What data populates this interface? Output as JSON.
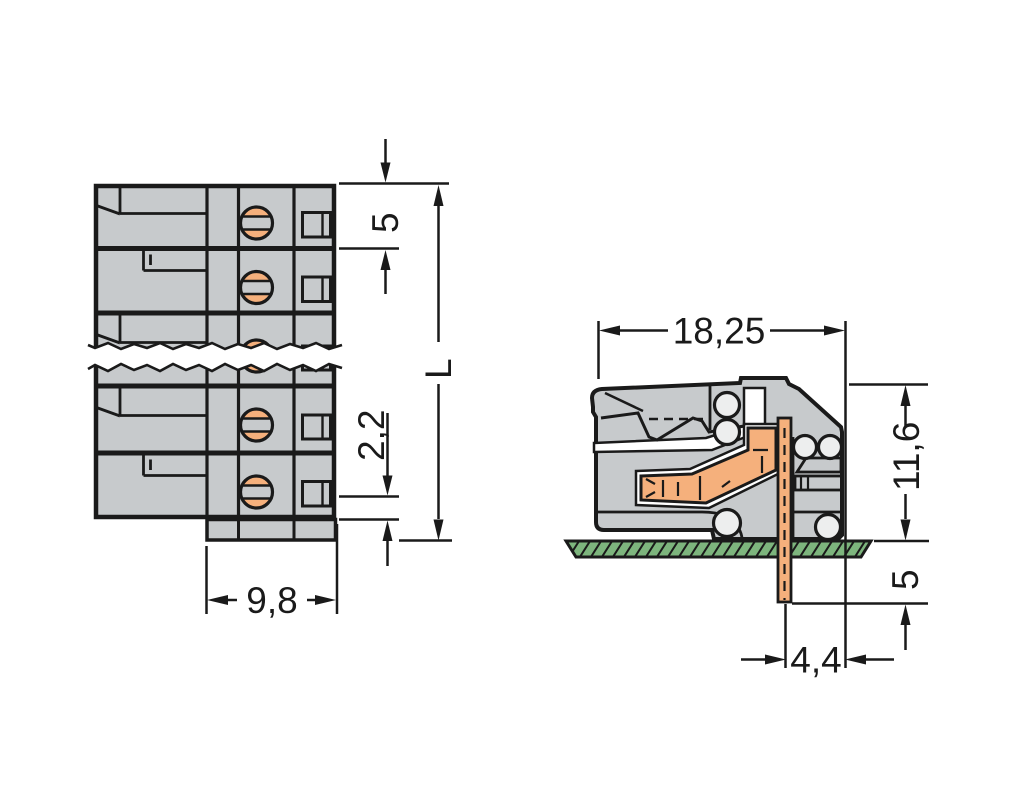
{
  "drawing": {
    "type": "technical-dimension-drawing",
    "views": {
      "front_view": "multi-pole female connector, front face with break line",
      "side_view": "connector cross-section mounted on PCB with solder pin"
    },
    "colors": {
      "housing_gray": "#c7cacc",
      "contact_orange": "#f5b07c",
      "pcb_green": "#7db57d",
      "detail_light": "#edeeee",
      "line_color": "#1a1a1a"
    },
    "dimensions": {
      "front": {
        "pole_pitch": "5",
        "rear_offset": "2,2",
        "depth": "9,8",
        "total_length": "L"
      },
      "side": {
        "total_depth": "18,25",
        "height_above_board": "11,6",
        "pin_length_below_board": "5",
        "pin_to_edge": "4,4"
      }
    }
  }
}
